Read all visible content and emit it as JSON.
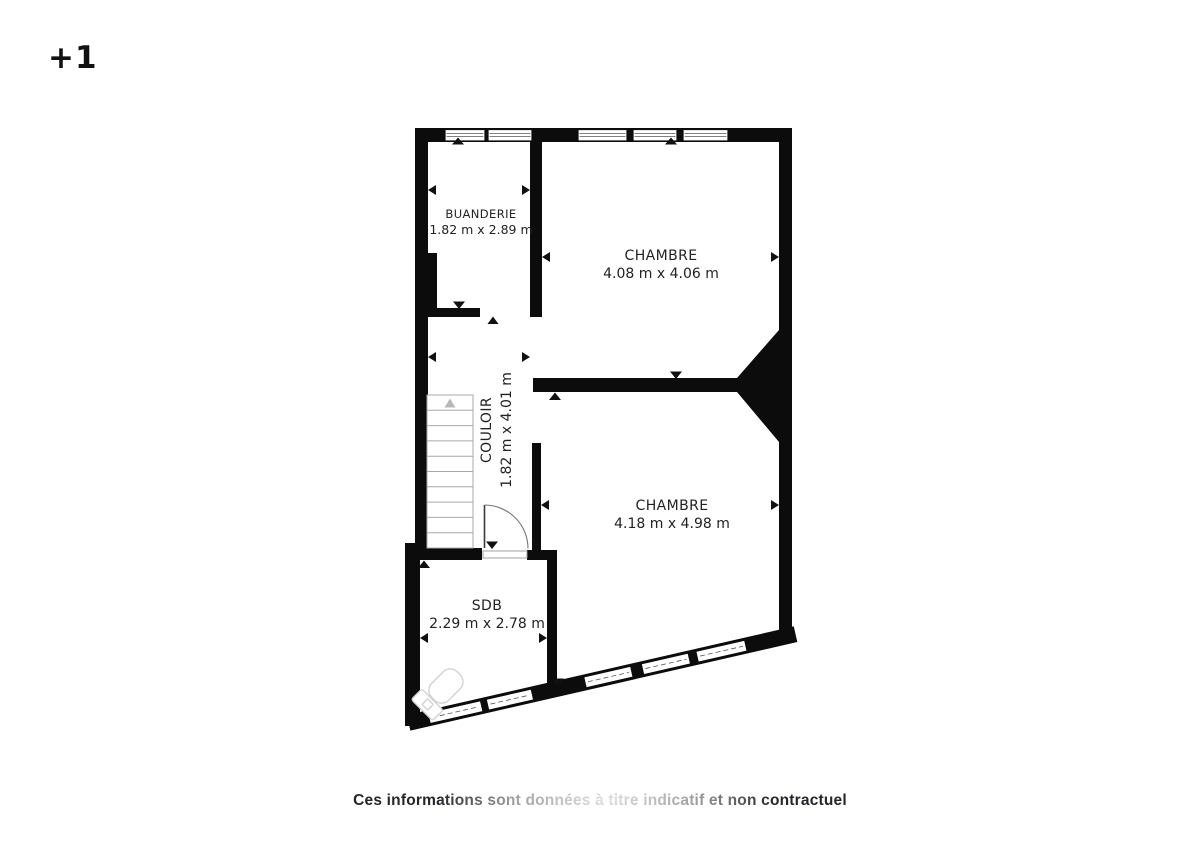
{
  "floor": {
    "label": "+1"
  },
  "rooms": {
    "buanderie": {
      "name": "BUANDERIE",
      "dims": "1.82 m x 2.89 m"
    },
    "chambre_top": {
      "name": "CHAMBRE",
      "dims": "4.08 m x 4.06 m"
    },
    "couloir": {
      "name": "COULOIR",
      "dims": "1.82 m x 4.01 m"
    },
    "chambre_bottom": {
      "name": "CHAMBRE",
      "dims": "4.18 m x 4.98 m"
    },
    "sdb": {
      "name": "SDB",
      "dims": "2.29 m x 2.78 m"
    }
  },
  "footer": {
    "disclaimer": "Ces informations sont données à titre indicatif et non contractuel"
  },
  "icons": {
    "stairs": "stairs-up-icon",
    "toilet": "toilet-icon",
    "door": "door-swing-icon"
  },
  "colors": {
    "wall": "#0c0c0c",
    "background": "#ffffff",
    "fixture_outline": "#d2d2d2",
    "stair_outline": "#a8a8a8",
    "text": "#222222"
  }
}
